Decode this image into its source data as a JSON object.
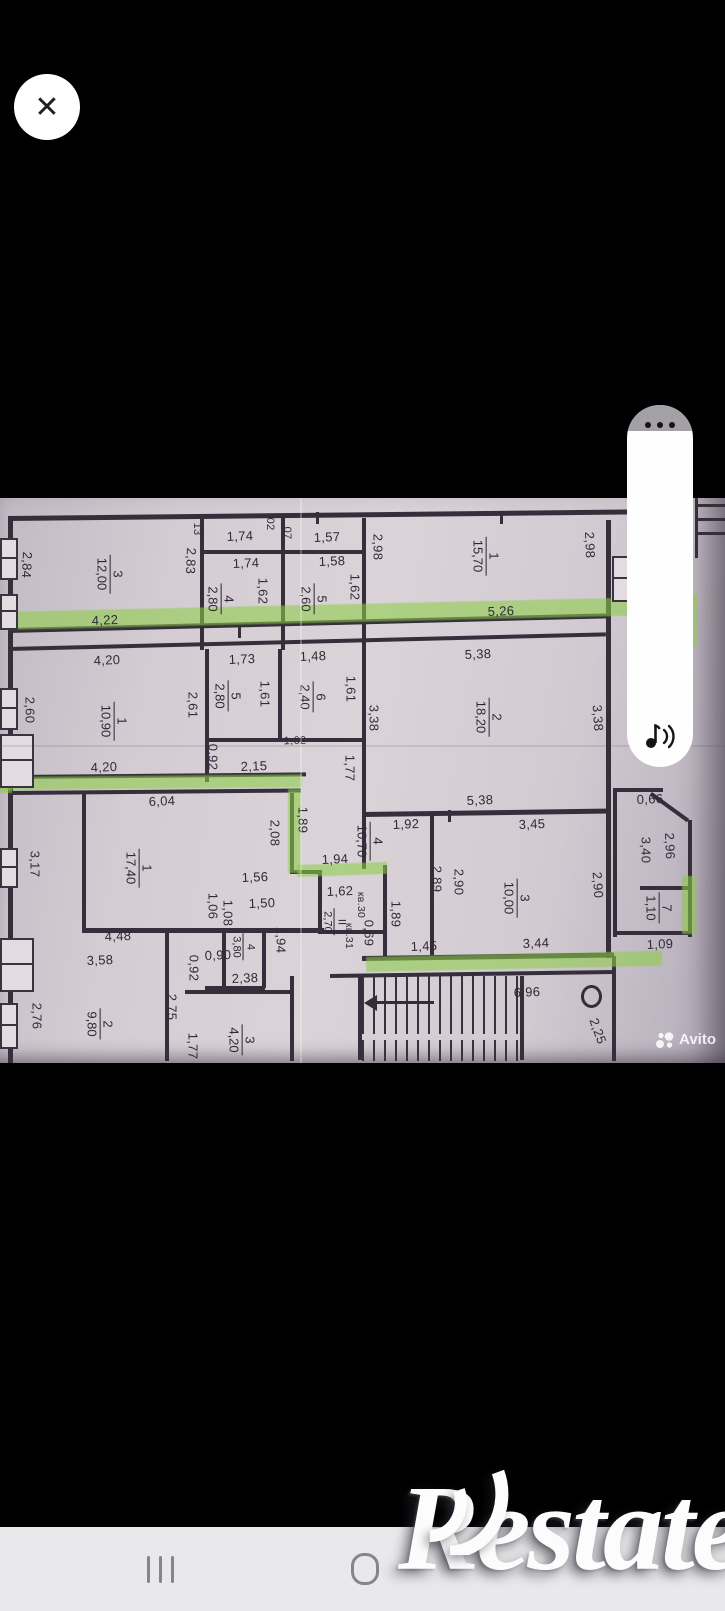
{
  "overlay": {
    "close_glyph": "✕"
  },
  "watermarks": {
    "avito": "Avito",
    "restate": "Restate"
  },
  "colors": {
    "highlight_green": "#8bcd46",
    "paper": "#d4ccd2",
    "background": "#000000",
    "navbar_gray": "#e9e8ea",
    "ink": "#322a38"
  },
  "plan": {
    "dimension_labels": [
      {
        "t": "1,74",
        "x": 240,
        "y": 38
      },
      {
        "t": "1,57",
        "x": 327,
        "y": 39
      },
      {
        "t": "1,74",
        "x": 246,
        "y": 65
      },
      {
        "t": "1,58",
        "x": 332,
        "y": 63
      },
      {
        "t": "13",
        "x": 197,
        "y": 31,
        "r": 90,
        "s": 11
      },
      {
        "t": "02",
        "x": 270,
        "y": 26,
        "r": 90,
        "s": 11
      },
      {
        "t": "07",
        "x": 287,
        "y": 35,
        "r": 90,
        "s": 11
      },
      {
        "t": "2,84",
        "x": 27,
        "y": 67,
        "r": 92
      },
      {
        "t": "2,83",
        "x": 191,
        "y": 63,
        "r": 92
      },
      {
        "t": "2,98",
        "x": 378,
        "y": 49,
        "r": 90
      },
      {
        "t": "2,98",
        "x": 590,
        "y": 47,
        "r": 88
      },
      {
        "t": "4,22",
        "x": 105,
        "y": 122
      },
      {
        "t": "5,26",
        "x": 501,
        "y": 113
      },
      {
        "t": "1,62",
        "x": 263,
        "y": 93,
        "r": 90
      },
      {
        "t": "1,62",
        "x": 355,
        "y": 89,
        "r": 90
      },
      {
        "t": "4,20",
        "x": 107,
        "y": 162
      },
      {
        "t": "1,73",
        "x": 242,
        "y": 161
      },
      {
        "t": "1,48",
        "x": 313,
        "y": 158
      },
      {
        "t": "5,38",
        "x": 478,
        "y": 156
      },
      {
        "t": "2,60",
        "x": 30,
        "y": 212,
        "r": 90
      },
      {
        "t": "2,61",
        "x": 193,
        "y": 207,
        "r": 90
      },
      {
        "t": "1,61",
        "x": 265,
        "y": 196,
        "r": 90
      },
      {
        "t": "1,61",
        "x": 351,
        "y": 191,
        "r": 90
      },
      {
        "t": "3,38",
        "x": 374,
        "y": 220,
        "r": 90
      },
      {
        "t": "3,38",
        "x": 598,
        "y": 220,
        "r": 86
      },
      {
        "t": "0,92",
        "x": 213,
        "y": 259,
        "r": 90
      },
      {
        "t": "2,15",
        "x": 254,
        "y": 268
      },
      {
        "t": "1,62",
        "x": 295,
        "y": 243,
        "s": 11
      },
      {
        "t": "1,77",
        "x": 350,
        "y": 270,
        "r": 90
      },
      {
        "t": "4,20",
        "x": 104,
        "y": 269
      },
      {
        "t": "5,38",
        "x": 480,
        "y": 302
      },
      {
        "t": "6,04",
        "x": 162,
        "y": 303
      },
      {
        "t": "1,92",
        "x": 406,
        "y": 326
      },
      {
        "t": "3,45",
        "x": 532,
        "y": 326
      },
      {
        "t": "2,08",
        "x": 275,
        "y": 335,
        "r": 90
      },
      {
        "t": "1,89",
        "x": 303,
        "y": 322,
        "r": 90
      },
      {
        "t": "3,17",
        "x": 35,
        "y": 366,
        "r": 90
      },
      {
        "t": "1,56",
        "x": 255,
        "y": 379
      },
      {
        "t": "1,50",
        "x": 262,
        "y": 405
      },
      {
        "t": "1,06",
        "x": 213,
        "y": 408,
        "r": 90
      },
      {
        "t": "1,08",
        "x": 228,
        "y": 415,
        "r": 90
      },
      {
        "t": "1,94",
        "x": 335,
        "y": 361
      },
      {
        "t": "1,62",
        "x": 340,
        "y": 393
      },
      {
        "t": "кв.30",
        "x": 361,
        "y": 407,
        "r": 90,
        "s": 10.5
      },
      {
        "t": "кв.31",
        "x": 349,
        "y": 438,
        "r": 90,
        "s": 10.5
      },
      {
        "t": "0,69",
        "x": 369,
        "y": 435,
        "r": 90
      },
      {
        "t": "1,89",
        "x": 396,
        "y": 416,
        "r": 90
      },
      {
        "t": "2,89",
        "x": 437,
        "y": 381,
        "r": 90
      },
      {
        "t": "2,90",
        "x": 459,
        "y": 384,
        "r": 90
      },
      {
        "t": "2,90",
        "x": 598,
        "y": 387,
        "r": 86
      },
      {
        "t": "3,40",
        "x": 646,
        "y": 352,
        "r": 90
      },
      {
        "t": "2,96",
        "x": 670,
        "y": 348,
        "r": 88
      },
      {
        "t": "0,66",
        "x": 650,
        "y": 301
      },
      {
        "t": "4,48",
        "x": 118,
        "y": 438
      },
      {
        "t": "3,58",
        "x": 100,
        "y": 462
      },
      {
        "t": "0,90",
        "x": 218,
        "y": 457
      },
      {
        "t": "0,92",
        "x": 194,
        "y": 470,
        "r": 90
      },
      {
        "t": "1,94",
        "x": 281,
        "y": 442,
        "r": 90
      },
      {
        "t": "2,38",
        "x": 245,
        "y": 480
      },
      {
        "t": "1,45",
        "x": 424,
        "y": 448
      },
      {
        "t": "3,44",
        "x": 536,
        "y": 445
      },
      {
        "t": "1,09",
        "x": 660,
        "y": 446
      },
      {
        "t": "2,76",
        "x": 37,
        "y": 518,
        "r": 90
      },
      {
        "t": "2,75",
        "x": 172,
        "y": 509,
        "r": 90
      },
      {
        "t": "1,77",
        "x": 193,
        "y": 548,
        "r": 90
      },
      {
        "t": "6,96",
        "x": 527,
        "y": 494
      },
      {
        "t": "2,25",
        "x": 598,
        "y": 533,
        "r": 70
      }
    ],
    "room_labels": [
      {
        "num": "3",
        "area": "12,00",
        "x": 110,
        "y": 76
      },
      {
        "num": "4",
        "area": "2,80",
        "x": 221,
        "y": 101
      },
      {
        "num": "5",
        "area": "2,60",
        "x": 314,
        "y": 101
      },
      {
        "num": "1",
        "area": "15,70",
        "x": 486,
        "y": 58
      },
      {
        "num": "1",
        "area": "10,90",
        "x": 114,
        "y": 223
      },
      {
        "num": "5",
        "area": "2,80",
        "x": 228,
        "y": 198
      },
      {
        "num": "6",
        "area": "2,40",
        "x": 313,
        "y": 199
      },
      {
        "num": "2",
        "area": "18,20",
        "x": 489,
        "y": 219
      },
      {
        "num": "1",
        "area": "17,40",
        "x": 139,
        "y": 370
      },
      {
        "num": "4",
        "area": "10,70",
        "x": 370,
        "y": 343
      },
      {
        "num": "3",
        "area": "10,00",
        "x": 517,
        "y": 400
      },
      {
        "num": "II",
        "area": "2,70",
        "x": 334,
        "y": 424,
        "s": 11
      },
      {
        "num": "4",
        "area": "3,80",
        "x": 243,
        "y": 449,
        "s": 11
      },
      {
        "num": "7",
        "area": "1,10",
        "x": 659,
        "y": 410
      },
      {
        "num": "2",
        "area": "9,80",
        "x": 100,
        "y": 526
      },
      {
        "num": "3",
        "area": "4,20",
        "x": 242,
        "y": 542
      }
    ]
  }
}
